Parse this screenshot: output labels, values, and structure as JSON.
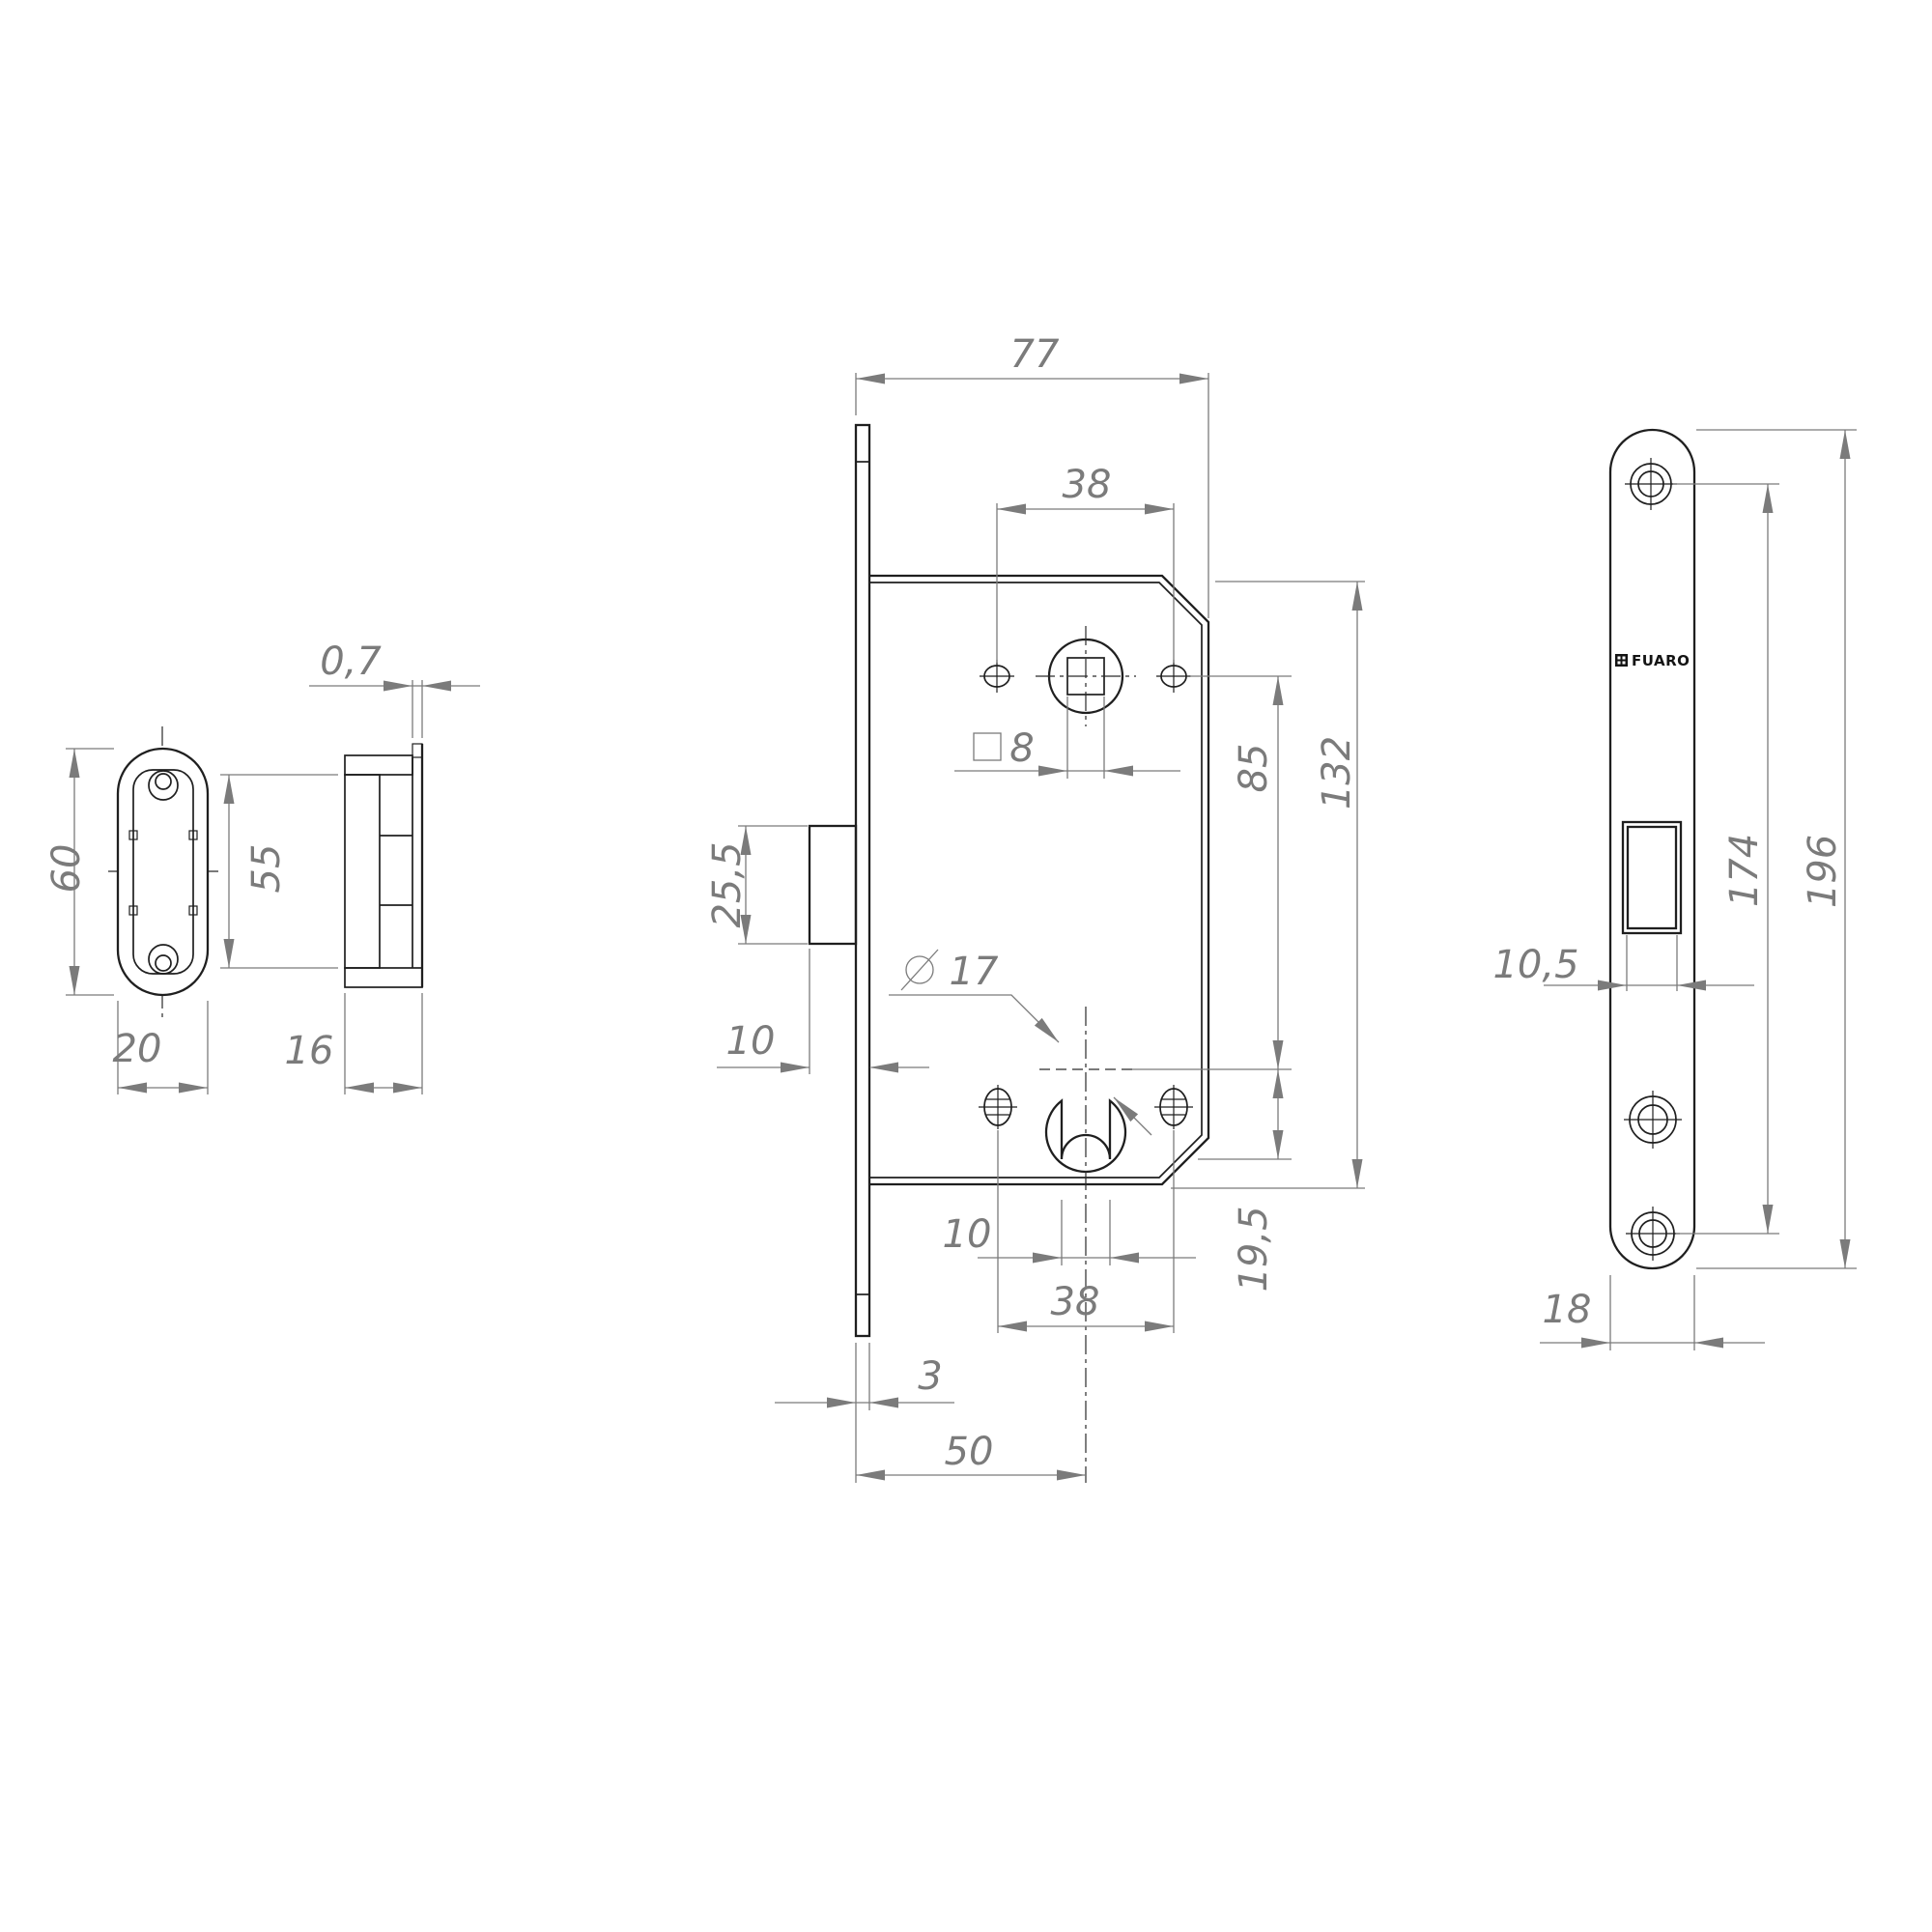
{
  "colors": {
    "background": "#ffffff",
    "outline": "#1f1f1f",
    "dimension": "#7b7b7b"
  },
  "brand": {
    "name": "FUARO"
  },
  "dims": {
    "body_width": "77",
    "top_screw_spacing": "38",
    "follower_square": "8",
    "latch_height": "25,5",
    "latch_protrusion": "10",
    "cylinder_diameter": "17",
    "screw_vertical_spacing": "85",
    "body_height": "132",
    "cylinder_to_bottom": "19,5",
    "keyway_width": "10",
    "bottom_screw_spacing": "38",
    "faceplate_thickness": "3",
    "backset": "50",
    "strike_lip": "0,7",
    "strike_box_height": "55",
    "strike_box_depth": "16",
    "strike_plate_height": "60",
    "strike_plate_width": "20",
    "latch_opening_width": "10,5",
    "faceplate_screw_spacing": "174",
    "faceplate_height": "196",
    "faceplate_width": "18"
  }
}
